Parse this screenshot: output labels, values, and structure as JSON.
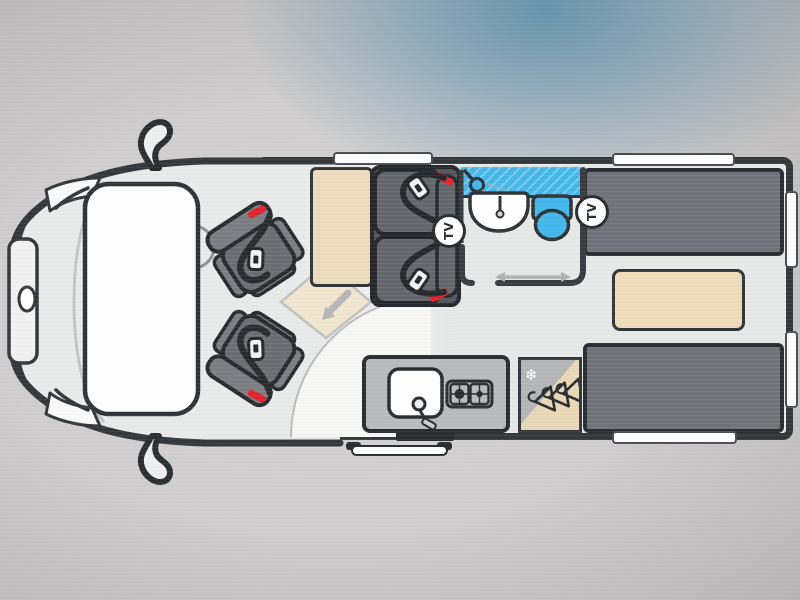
{
  "diagram": {
    "type": "campervan-floorplan-top-view",
    "tv_badges": [
      {
        "label": "TV"
      },
      {
        "label": "TV"
      }
    ],
    "fridge": {
      "snowflake_glyph": "❄"
    },
    "colors": {
      "wall": "#35383b",
      "floor": "#e9eaea",
      "upholstery_gray": "#6b6f74",
      "bed_gray": "#70747a",
      "furniture_tan": "#ecdcbd",
      "wet_room_blue": "#45b7ea",
      "seatbelt_red": "#e4232b",
      "background_glow_blue": "#588caa"
    },
    "icons": [
      "wing-mirror-icon",
      "windshield",
      "steering-wheel-icon",
      "swivel-seat-icon",
      "seatbelt-icon",
      "seatbelt-buckle-icon",
      "tv-badge",
      "table-extension-arrow-icon",
      "shower-head-icon",
      "washbasin-icon",
      "toilet-icon",
      "sliding-door-arrow-icon",
      "sink-icon",
      "two-burner-hob-icon",
      "snowflake-icon",
      "wardrobe-hangers-icon",
      "window-bar"
    ]
  }
}
